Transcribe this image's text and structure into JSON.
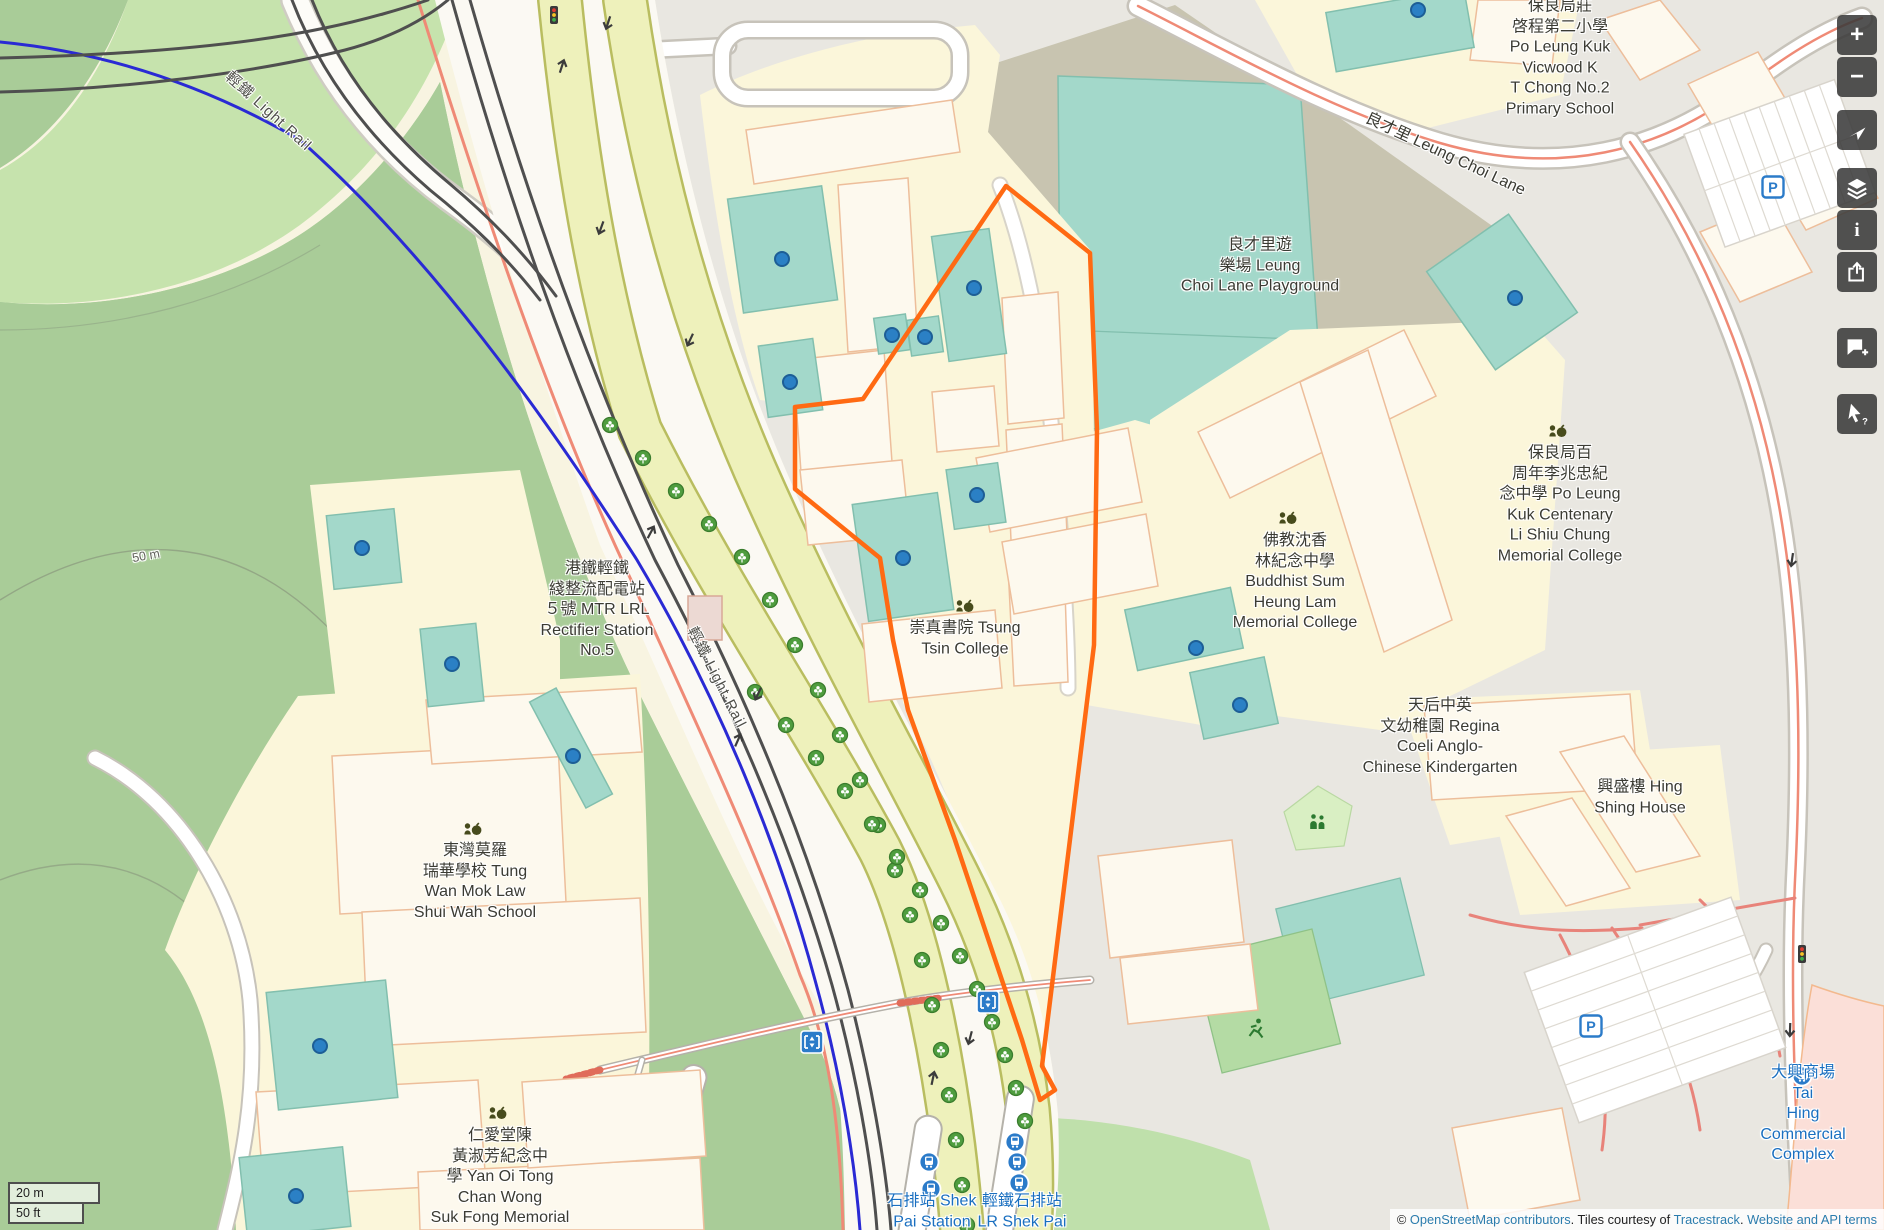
{
  "labels": {
    "vicwood": {
      "text": "保良局莊\n啓程第二小學\nPo Leung Kuk\nVicwood K\nT Chong No.2\nPrimary School"
    },
    "playground": {
      "text": "良才里遊\n樂場 Leung\nChoi Lane Playground"
    },
    "centenary": {
      "text": "保良局百\n周年李兆忠紀\n念中學 Po Leung\nKuk Centenary\nLi Shiu Chung\nMemorial College"
    },
    "buddhist": {
      "text": "佛教沈香\n林紀念中學\nBuddhist Sum\nHeung Lam\nMemorial College"
    },
    "tsung_tsin": {
      "text": "崇真書院 Tsung\nTsin College"
    },
    "rectifier": {
      "text": "港鐵輕鐵\n綫整流配電站\n５號 MTR LRL\nRectifier Station\nNo.5"
    },
    "regina": {
      "text": "天后中英\n文幼稚園 Regina\nCoeli Anglo-\nChinese Kindergarten"
    },
    "hing_shing": {
      "text": "興盛樓 Hing\nShing House"
    },
    "tung_wan": {
      "text": "東灣莫羅\n瑞華學校 Tung\nWan Mok Law\nShui Wah School"
    },
    "yan_oi": {
      "text": "仁愛堂陳\n黃淑芳紀念中\n學 Yan Oi Tong\nChan Wong\nSuk Fong Memorial"
    },
    "shek_pai": {
      "text": "石排站 Shek\nPai Station"
    },
    "lr_shek_pai": {
      "text": "輕鐵石排站\nLR Shek Pai"
    },
    "tai_hing": {
      "text": "大興商場 Tai\nHing Commercial\nComplex"
    },
    "light_rail_nw": {
      "text": "輕鐵 Light Rail"
    },
    "light_rail_mid": {
      "text": "輕鐵·Light·Rail"
    },
    "leung_choi_lane": {
      "text": "良才里 Leung Choi Lane"
    },
    "contour_50m": {
      "text": "50 m"
    }
  },
  "controls": {
    "zoom_in_label": "+",
    "zoom_out_label": "−",
    "map_key_label": "i",
    "query_label": "?"
  },
  "scalebar": {
    "metric": "20 m",
    "imperial": "50 ft"
  },
  "attribution": {
    "prefix": "© ",
    "osm_link": "OpenStreetMap contributors",
    "middle": ". Tiles courtesy of ",
    "tiles_link": "Tracestrack",
    "sep": ". ",
    "terms_link": "Website and API terms"
  },
  "colors": {
    "forest": "#a9cc98",
    "light_green": "#c6e3ad",
    "pitch_teal": "#a3d8ca",
    "school_cream": "#fbf6da",
    "building": "#fdf9ee",
    "building_stroke": "#edbe9b",
    "urban_gray": "#e9e7e1",
    "playground_olive": "#c8c4b0",
    "corridor_yellow": "#eef1bb",
    "road_casing": "#c7c3ba",
    "salmon_route": "#ef8a76",
    "rail_blue": "#2a2ad4",
    "rail_dark": "#4f4f4f",
    "selection_orange": "#ff6a13",
    "poi_dot": "#2b80c5",
    "transit_blue": "#2b7bc9",
    "label_blue": "#1a6fc0"
  }
}
